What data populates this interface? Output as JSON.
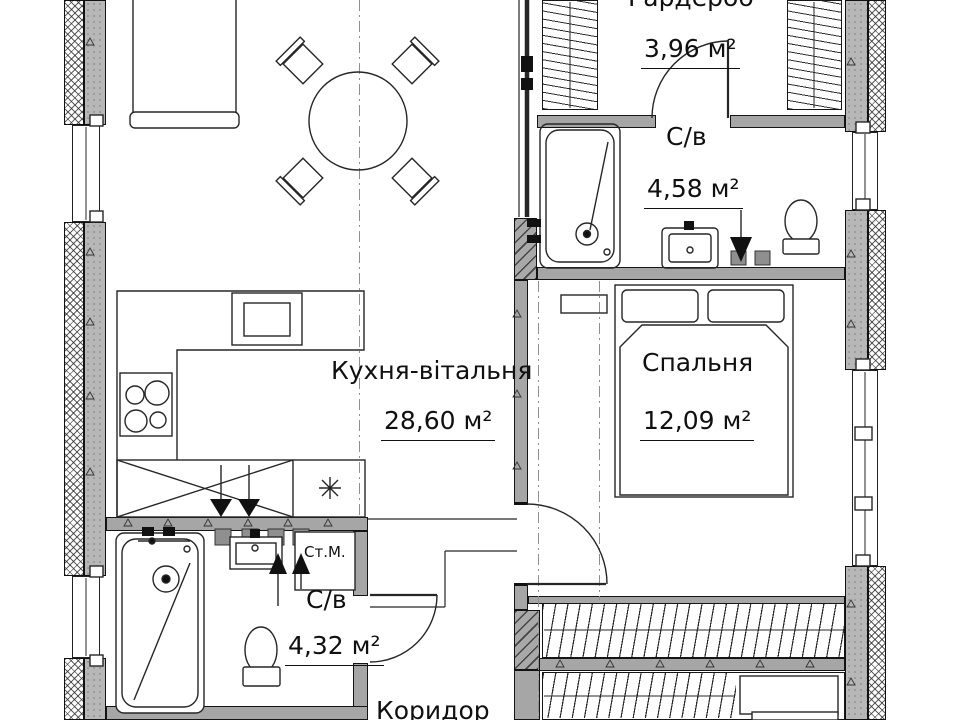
{
  "plan": {
    "rooms": {
      "wardrobe": {
        "name": "Гардероб",
        "area": "3,96 м²"
      },
      "bathroom_top": {
        "name": "С/в",
        "area": "4,58 м²"
      },
      "kitchen_living": {
        "name": "Кухня-вітальня",
        "area": "28,60 м²"
      },
      "bedroom": {
        "name": "Спальня",
        "area": "12,09 м²"
      },
      "bathroom_bottom": {
        "name": "С/в",
        "area": "4,32 м²"
      },
      "corridor": {
        "name": "Коридор"
      }
    },
    "annotations": {
      "washing_machine": "Ст.М."
    },
    "colors": {
      "background": "#ffffff",
      "wall_concrete": "#b7b7b7",
      "wall_partition": "#a6a6a6",
      "line": "#262626"
    }
  }
}
